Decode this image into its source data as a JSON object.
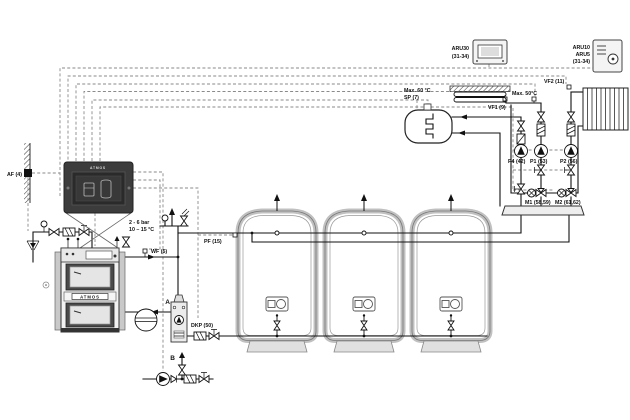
{
  "diagram_title": "ATMOS wood gasification boiler system schematic with buffer tanks, DHW tank and two mixed heating circuits",
  "branding": {
    "panel": "ATMOS",
    "boiler": "ATMOS"
  },
  "labels": {
    "af": "AF (4)",
    "wf": "WF (5)",
    "bar_range": "2 - 6 bar",
    "temp_range": "10 – 15 °C",
    "point_a": "A",
    "point_b": "B",
    "dkp": "DKP (50)",
    "pf": "PF (15)",
    "max60": "Max. 60 °C",
    "sp": "SP (7)",
    "vf1": "VF1 (9)",
    "vf2": "VF2 (11)",
    "max50": "Max. 50°C",
    "p4": "P4 (42)",
    "p1": "P1 (53)",
    "p2": "P2 (56)",
    "m1": "M1 (58,59)",
    "m2": "M2 (61,62)"
  },
  "room_units": {
    "aru30": {
      "name": "ARU30",
      "terminals": "(31-34)"
    },
    "aru10": {
      "name_line1": "ARU10",
      "name_line2": "ARU5",
      "terminals": "(31-34)"
    }
  },
  "colors": {
    "pipe": "#111111",
    "control_wire": "#8a8a8a",
    "boiler_dark": "#4a4a4a",
    "insulation": "#c0c0c0"
  }
}
